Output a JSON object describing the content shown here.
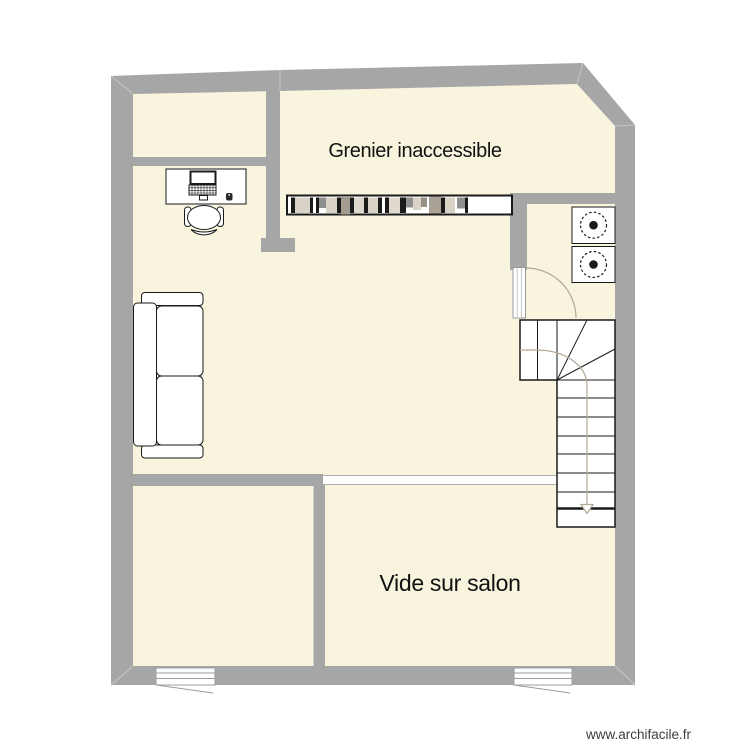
{
  "plan": {
    "rooms": [
      {
        "label": "Grenier inaccessible"
      },
      {
        "label": "Vide sur salon"
      }
    ],
    "watermark": "www.archifacile.fr"
  },
  "colors": {
    "canvas": "#ffffff",
    "floor": "#f8f4de",
    "wall": "#a6a6a6",
    "wall_seam": "#c6c6c6",
    "ink": "#1a1a1a",
    "walkline": "#b4a896",
    "opening_line": "#b0b0b0",
    "window_line": "#9c9c9c",
    "label": "#111111",
    "watermark": "#3d3d3d"
  },
  "furniture_icons": [
    "desk-with-laptop-icon",
    "office-chair-icon",
    "sofa-icon",
    "bookshelf-icon",
    "hotplate-icon",
    "hotplate-icon",
    "door-swing-icon",
    "staircase-icon",
    "window-icon",
    "window-icon"
  ],
  "bookshelf": {
    "books": [
      {
        "w": 4,
        "h": 15.5,
        "dy": 0.5,
        "c": "ink"
      },
      {
        "w": 15,
        "h": 15.5,
        "dy": 0.5,
        "c": "#d9d3c7"
      },
      {
        "w": 3,
        "h": 15.5,
        "dy": 0.5,
        "c": "ink"
      },
      {
        "w": 3,
        "h": 0,
        "dy": 0,
        "c": "gap"
      },
      {
        "w": 3,
        "h": 15.5,
        "dy": 0.5,
        "c": "ink"
      },
      {
        "w": 7,
        "h": 10.5,
        "dy": 0.5,
        "c": "#8f8f8f"
      },
      {
        "w": 11,
        "h": 15.5,
        "dy": 0.5,
        "c": "#d9d3c7"
      },
      {
        "w": 4,
        "h": 15.5,
        "dy": 0.5,
        "c": "ink"
      },
      {
        "w": 9,
        "h": 18.5,
        "dy": -1,
        "c": "#a49c90"
      },
      {
        "w": 4,
        "h": 15.5,
        "dy": 0.5,
        "c": "ink"
      },
      {
        "w": 10,
        "h": 15.5,
        "dy": 0.5,
        "c": "#ddd7cb"
      },
      {
        "w": 4,
        "h": 15.5,
        "dy": 0.5,
        "c": "ink"
      },
      {
        "w": 10,
        "h": 15.5,
        "dy": 0.5,
        "c": "#d9d3c7"
      },
      {
        "w": 4,
        "h": 15.5,
        "dy": 0.5,
        "c": "ink"
      },
      {
        "w": 3,
        "h": 0,
        "dy": 0,
        "c": "gap"
      },
      {
        "w": 4,
        "h": 15.5,
        "dy": 0.5,
        "c": "ink"
      },
      {
        "w": 11,
        "h": 15.5,
        "dy": 0.5,
        "c": "#e0dace"
      },
      {
        "w": 3,
        "h": 15.5,
        "dy": 0.5,
        "c": "ink"
      },
      {
        "w": 3,
        "h": 15.5,
        "dy": 0.5,
        "c": "ink"
      },
      {
        "w": 7,
        "h": 10,
        "dy": 0.5,
        "c": "#8f8f8f"
      },
      {
        "w": 8,
        "h": 12.5,
        "dy": 0.5,
        "c": "#d9d3c7"
      },
      {
        "w": 6,
        "h": 9.5,
        "dy": 0.5,
        "c": "#979088"
      },
      {
        "w": 2,
        "h": 0,
        "dy": 0,
        "c": "gap"
      },
      {
        "w": 12,
        "h": 17,
        "dy": -0.5,
        "c": "#aaa296"
      },
      {
        "w": 4,
        "h": 15.5,
        "dy": 0.5,
        "c": "ink"
      },
      {
        "w": 10,
        "h": 15.5,
        "dy": 0.5,
        "c": "#d9d3c7"
      },
      {
        "w": 2,
        "h": 0,
        "dy": 0,
        "c": "gap"
      },
      {
        "w": 8,
        "h": 11,
        "dy": 0.5,
        "c": "#8f8f8f"
      },
      {
        "w": 3,
        "h": 15.5,
        "dy": 0.5,
        "c": "ink"
      }
    ]
  },
  "staircase": {
    "step_lines_y": [
      380,
      398,
      417,
      436,
      454,
      473,
      492
    ],
    "thick_line_y": 508.5,
    "flight_x": [
      557,
      615
    ],
    "direction": "down-arrow"
  }
}
